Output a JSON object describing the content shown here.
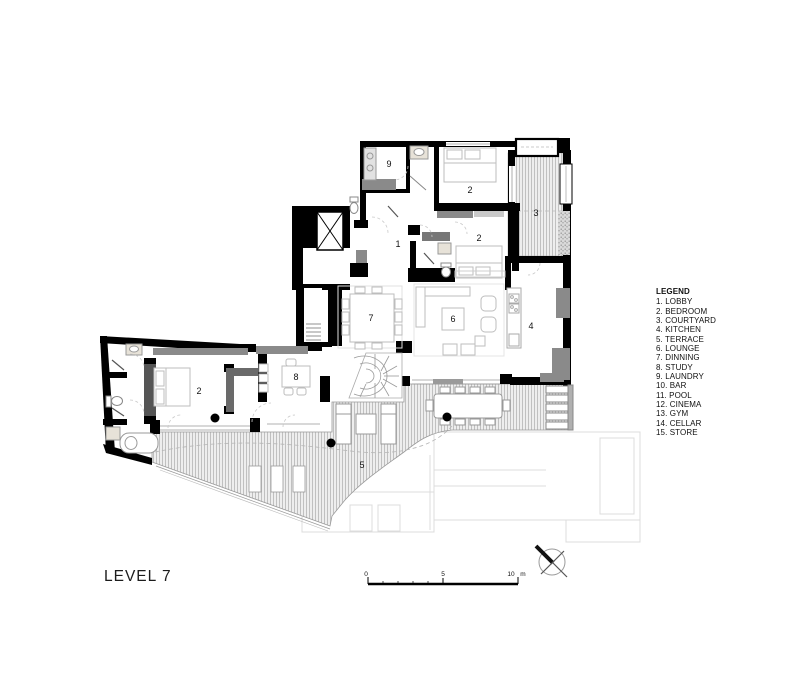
{
  "title": "LEVEL 7",
  "legend": {
    "title": "LEGEND",
    "items": [
      "1. LOBBY",
      "2. BEDROOM",
      "3. COURTYARD",
      "4. KITCHEN",
      "5. TERRACE",
      "6. LOUNGE",
      "7. DINNING",
      "8. STUDY",
      "9. LAUNDRY",
      "10. BAR",
      "11. POOL",
      "12. CINEMA",
      "13. GYM",
      "14. CELLAR",
      "15. STORE"
    ]
  },
  "room_labels": {
    "laundry": "9",
    "bedroom_top": "2",
    "courtyard": "3",
    "lobby": "1",
    "bedroom_mid": "2",
    "kitchen": "4",
    "dinning": "7",
    "lounge": "6",
    "study": "8",
    "bedroom_lower": "2",
    "terrace": "5"
  },
  "scale_bar": {
    "zero": "0",
    "five": "5",
    "ten": "10",
    "unit": "m"
  },
  "icons": {
    "north_arrow": "compass-north-arrow",
    "elevator": "elevator-x"
  },
  "colors": {
    "wall": "#000000",
    "gray_fill": "#8a8a8a",
    "dark_gray": "#6a6a6a",
    "hatch_line": "#b5b5b5",
    "furniture": "#bdbdbd",
    "ghost": "#dcdcdc"
  }
}
